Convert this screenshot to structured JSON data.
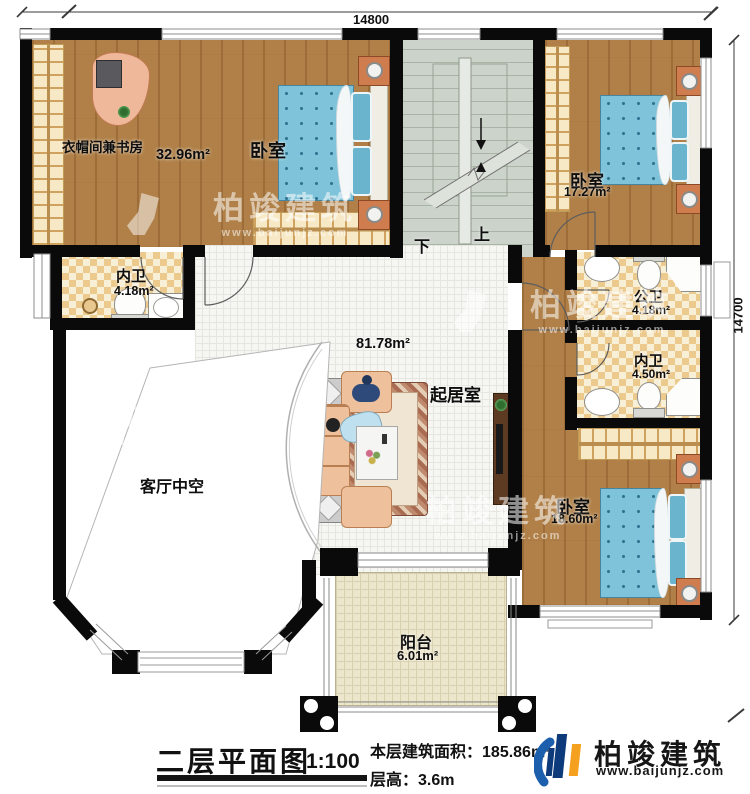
{
  "dimensions": {
    "width_top": "14800",
    "height_right": "14700"
  },
  "rooms": {
    "study": {
      "name": "衣帽间兼书房",
      "area": "32.96m²"
    },
    "bedroom_top": {
      "name": "卧室"
    },
    "bedroom_right": {
      "name": "卧室",
      "area": "17.27m²"
    },
    "bath_left": {
      "name": "内卫",
      "area": "4.18m²"
    },
    "bath_public": {
      "name": "公卫",
      "area": "4.18m²"
    },
    "bath_inner": {
      "name": "内卫",
      "area": "4.50m²"
    },
    "bedroom_bottom": {
      "name": "卧室",
      "area": "18.60m²"
    },
    "living": {
      "name": "起居室",
      "area": "81.78m²"
    },
    "void": {
      "name": "客厅中空"
    },
    "balcony": {
      "name": "阳台",
      "area": "6.01m²"
    }
  },
  "stairs": {
    "up_label": "上",
    "down_label": "下"
  },
  "watermark": {
    "brand": "柏竣建筑",
    "site": "www.baijunjz.com"
  },
  "footer": {
    "plan_title": "二层平面图",
    "scale": "1:100",
    "floor_area_label": "本层建筑面积：",
    "floor_area_value": "185.86m²",
    "floor_height_label": "层高：",
    "floor_height_value": "3.6m"
  },
  "logo": {
    "brand": "柏竣建筑",
    "site": "www.baijunjz.com"
  },
  "colors": {
    "wall": "#0a0a0a",
    "wood_floor": "#b08048",
    "tile_bath": "#ecca8e",
    "bed_blue": "#7ec3da",
    "stair_gray": "#ccd3cb",
    "balcony_tile": "#ece6cc",
    "sofa_peach": "#eec09b",
    "logo_blue": "#1b5fad",
    "logo_orange": "#f5a01e"
  }
}
